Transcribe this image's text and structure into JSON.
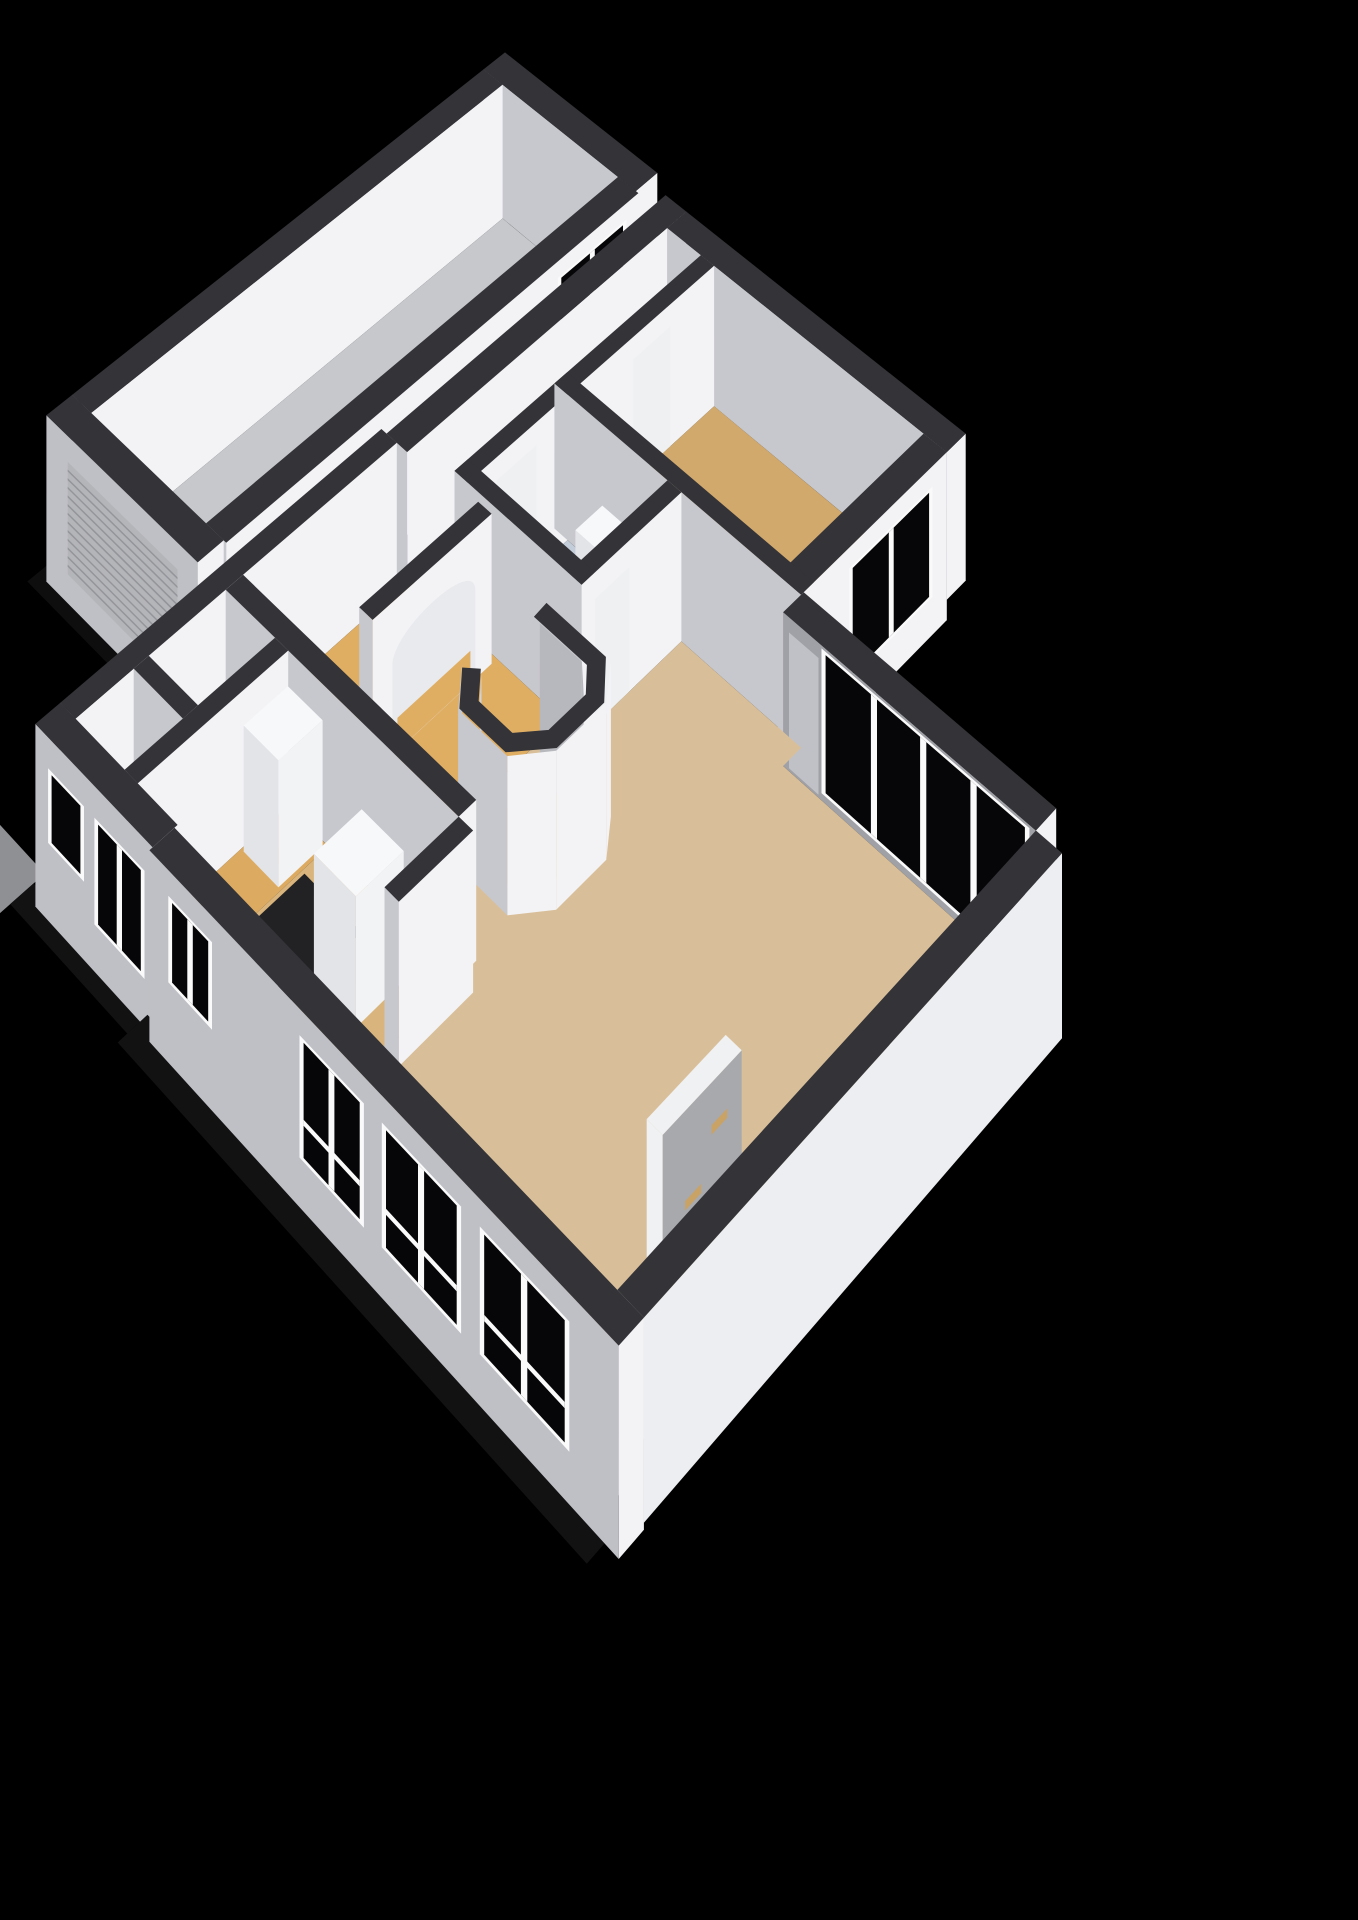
{
  "scene": {
    "proj": {
      "ox": 505,
      "oy": 185,
      "ux": 47.5,
      "uy": 39,
      "uz": 52,
      "p": 0.0107
    },
    "wallH": 2.55,
    "palette": {
      "bg": "#000000",
      "wallTop": "#333338",
      "wallBright": "#f3f3f6",
      "wallShade": "#c7c8cd",
      "wallShadeDark": "#a0a1a6",
      "extShade": "#bfc0c5",
      "glass": "#060608",
      "frame": "#fafafb",
      "floorGarage": "#c6c8cc",
      "floorCorridor": "#ced1d6",
      "floorBed": "#d2a96d",
      "floorBath": "#c3cdd9",
      "floorHall": "#dfae63",
      "floorHall2": "#dcab61",
      "floorLiving": "#d9bf99",
      "floorKitchen": "#d9b57d",
      "floorToilet": "#c6cfda",
      "floorStorage": "#d3d5d9",
      "floorDark": "#222225",
      "ground": "#8f9094",
      "groundDim": "#39393c",
      "shadow": "#121213",
      "doorPanel": "#eef0f2",
      "doorGray": "#c0c1c6",
      "slabGray": "#a8a9ad",
      "slabWhite": "#f0f1f3",
      "gold": "#c9a266",
      "innerBright": "#d2d3d7",
      "innerShade": "#b7b8bd",
      "furnTop": "#f7f8fa",
      "furnBright": "#f2f3f5",
      "furnShade": "#e3e4e8",
      "roller": "#b4b5b9",
      "rollerLine": "#94959a",
      "archFill": "#e9eaed"
    },
    "elements": [
      {
        "t": "prism",
        "name": "garage-north-wall",
        "r": [
          0,
          0,
          3.1,
          0.45
        ]
      },
      {
        "t": "prism",
        "name": "garage-west-wall",
        "r": [
          0,
          0.45,
          0.4,
          8.3
        ]
      },
      {
        "t": "floor",
        "name": "garage-floor",
        "r": [
          0.4,
          0.45,
          2.75,
          8.3
        ],
        "fill": "floorGarage"
      },
      {
        "t": "prism",
        "name": "garage-east-wall",
        "r": [
          2.75,
          0.45,
          3.15,
          8.3
        ]
      },
      {
        "t": "window",
        "name": "garage-window",
        "edge": [
          [
            3.15,
            0.7
          ],
          [
            3.15,
            2.1
          ]
        ],
        "z": [
          0.35,
          2.25
        ],
        "panes": 2
      },
      {
        "t": "floor",
        "name": "garage-south-shadow",
        "r": [
          0.05,
          8.78,
          3.05,
          9.12
        ],
        "fill": "#0e0e0f"
      },
      {
        "t": "prism",
        "name": "garage-south-wall",
        "r": [
          0,
          8.3,
          3.1,
          8.75
        ],
        "z0": -0.35,
        "dark": "extShade"
      },
      {
        "t": "panel",
        "name": "garage-roller-door",
        "edge": [
          [
            0.45,
            8.75
          ],
          [
            2.7,
            8.75
          ]
        ],
        "z": [
          0.15,
          2.1
        ],
        "fill": "roller",
        "stripes": 12,
        "stripeColor": "rollerLine"
      },
      {
        "t": "prism",
        "name": "house-northwest-wall",
        "r": [
          3.45,
          0.2,
          3.85,
          5.7
        ]
      },
      {
        "t": "prism",
        "name": "bedroom-north-wall",
        "r": [
          3.85,
          0.2,
          8.95,
          0.6
        ]
      },
      {
        "t": "floor",
        "name": "corridor-floor",
        "r": [
          3.85,
          0.6,
          4.5,
          5.45
        ],
        "fill": "floorCorridor"
      },
      {
        "t": "prism",
        "name": "corridor-east-wall",
        "r": [
          4.5,
          0.6,
          4.75,
          5.45
        ]
      },
      {
        "t": "panel",
        "name": "bedroom-door",
        "edge": [
          [
            4.75,
            1.5
          ],
          [
            4.75,
            2.25
          ]
        ],
        "z": [
          0,
          2.15
        ],
        "fill": "doorPanel"
      },
      {
        "t": "panel",
        "name": "bathroom-west-door",
        "edge": [
          [
            4.75,
            4.15
          ],
          [
            4.75,
            4.9
          ]
        ],
        "z": [
          0,
          2.15
        ],
        "fill": "doorPanel"
      },
      {
        "t": "floor",
        "name": "bedroom-floor",
        "r": [
          4.75,
          0.6,
          8.55,
          3.3
        ],
        "fill": "floorBed"
      },
      {
        "t": "prism",
        "name": "bedroom-east-wall",
        "r": [
          8.55,
          0.6,
          8.95,
          3.55
        ],
        "z0": -0.35
      },
      {
        "t": "window",
        "name": "bedroom-window",
        "edge": [
          [
            8.95,
            0.9
          ],
          [
            8.95,
            2.6
          ]
        ],
        "z": [
          0.3,
          2.2
        ],
        "panes": 2
      },
      {
        "t": "prism",
        "name": "bedroom-south-wall",
        "r": [
          4.5,
          3.3,
          8.95,
          3.55
        ]
      },
      {
        "t": "floor",
        "name": "bathroom-floor",
        "r": [
          4.75,
          3.55,
          6.6,
          5.2
        ],
        "fill": "floorBath"
      },
      {
        "t": "prism",
        "name": "bathroom-sink",
        "r": [
          5.45,
          3.6,
          6.15,
          4.12
        ],
        "z0": 0.78,
        "z1": 1.22,
        "top": "furnTop",
        "bright": "furnBright",
        "dark": "furnShade"
      },
      {
        "t": "prism",
        "name": "shower-screen",
        "r": [
          6.28,
          4.7,
          6.6,
          5.2
        ],
        "z1": 2.0,
        "top": "#d7d9dd",
        "bright": "#dcdee2",
        "dark": "#cdd0d5"
      },
      {
        "t": "prism",
        "name": "bathroom-east-wall",
        "r": [
          6.6,
          3.55,
          6.85,
          5.45
        ]
      },
      {
        "t": "panel",
        "name": "bathroom-door",
        "edge": [
          [
            6.85,
            4.55
          ],
          [
            6.85,
            5.3
          ]
        ],
        "z": [
          0,
          2.1
        ],
        "fill": "doorPanel"
      },
      {
        "t": "prism",
        "name": "bathroom-south-wall",
        "r": [
          4.5,
          5.2,
          6.85,
          5.45
        ]
      },
      {
        "t": "prism",
        "name": "utility-west-wall",
        "r": [
          3.35,
          5.7,
          3.65,
          11.25
        ]
      },
      {
        "t": "prism",
        "name": "living-north-wall",
        "r": [
          8.95,
          3.5,
          13.05,
          3.9
        ],
        "dark": "wallShadeDark"
      },
      {
        "t": "panel",
        "name": "terrace-door",
        "edge": [
          [
            9.05,
            3.9
          ],
          [
            9.55,
            3.9
          ]
        ],
        "z": [
          0.05,
          2.3
        ],
        "fill": "doorGray"
      },
      {
        "t": "window",
        "name": "living-window-band",
        "edge": [
          [
            9.6,
            3.9
          ],
          [
            12.95,
            3.9
          ]
        ],
        "z": [
          0.12,
          2.5
        ],
        "panes": 4
      },
      {
        "t": "floor",
        "name": "hall-floor",
        "r": [
          3.65,
          5.45,
          6.5,
          8.45
        ],
        "fill": "floorHall"
      },
      {
        "t": "floor",
        "name": "living-floor",
        "pts": [
          [
            6.85,
            3.55
          ],
          [
            8.95,
            3.55
          ],
          [
            8.95,
            3.9
          ],
          [
            13.05,
            3.9
          ],
          [
            13.05,
            11.3
          ],
          [
            7.95,
            11.3
          ],
          [
            7.95,
            8.75
          ],
          [
            6.5,
            8.75
          ],
          [
            6.5,
            5.45
          ],
          [
            6.85,
            5.45
          ]
        ],
        "fill": "floorLiving"
      },
      {
        "t": "prism",
        "name": "arch-wall",
        "r": [
          5.05,
          5.55,
          5.3,
          7.7
        ]
      },
      {
        "t": "arch",
        "name": "arched-opening",
        "edge": [
          [
            5.3,
            5.85
          ],
          [
            5.3,
            7.35
          ]
        ],
        "fill": "archFill",
        "floorFill": "floorHall"
      },
      {
        "t": "floor",
        "name": "stairwell-floor",
        "pts": [
          [
            6.85,
            6.22
          ],
          [
            7.6,
            6.22
          ],
          [
            7.92,
            6.52
          ],
          [
            7.92,
            7.15
          ],
          [
            7.6,
            7.5
          ],
          [
            7.05,
            7.5
          ],
          [
            6.8,
            7.22
          ]
        ],
        "fill": "floorHall"
      },
      {
        "t": "wallpath",
        "name": "stairwell-inner-wall",
        "pts": [
          [
            6.8,
            7.22
          ],
          [
            7.05,
            7.5
          ],
          [
            7.6,
            7.5
          ],
          [
            7.92,
            7.15
          ],
          [
            7.92,
            6.52
          ],
          [
            7.6,
            6.22
          ],
          [
            6.85,
            6.22
          ]
        ],
        "bright": "innerBright",
        "dark": "innerShade"
      },
      {
        "t": "wallpath",
        "name": "stairwell-outer-wall",
        "pts": [
          [
            6.6,
            5.95
          ],
          [
            7.85,
            5.95
          ],
          [
            8.2,
            6.4
          ],
          [
            8.2,
            7.3
          ],
          [
            7.82,
            7.78
          ],
          [
            6.95,
            7.78
          ],
          [
            6.55,
            7.32
          ]
        ]
      },
      {
        "t": "ringtop",
        "name": "stairwell-wall-top",
        "pts": [
          [
            6.72,
            6.08
          ],
          [
            7.72,
            6.08
          ],
          [
            8.06,
            6.46
          ],
          [
            8.06,
            7.22
          ],
          [
            7.71,
            7.64
          ],
          [
            7.0,
            7.64
          ],
          [
            6.67,
            7.27
          ]
        ],
        "w": 0.34
      },
      {
        "t": "prism",
        "name": "utility-north-wall",
        "r": [
          3.65,
          8.45,
          7.95,
          8.75
        ]
      },
      {
        "t": "floor",
        "name": "storage-floor",
        "r": [
          3.65,
          8.75,
          4.6,
          10.05
        ],
        "fill": "floorStorage"
      },
      {
        "t": "prism",
        "name": "toilet-divider-wall",
        "r": [
          3.65,
          10.05,
          4.6,
          10.3
        ]
      },
      {
        "t": "floor",
        "name": "toilet-floor",
        "r": [
          3.65,
          10.3,
          4.6,
          11.25
        ],
        "fill": "floorToilet"
      },
      {
        "t": "prism",
        "name": "utility-divider-wall",
        "r": [
          4.6,
          8.75,
          4.85,
          11.25
        ]
      },
      {
        "t": "floor",
        "name": "back-hall-floor",
        "r": [
          4.85,
          8.75,
          5.6,
          11.3
        ],
        "fill": "floorHall2"
      },
      {
        "t": "prism",
        "name": "closet-cabinet",
        "r": [
          4.9,
          8.8,
          5.55,
          9.55
        ],
        "z1": 2.05,
        "top": "furnTop",
        "bright": "furnBright",
        "dark": "furnShade"
      },
      {
        "t": "floor",
        "name": "kitchen-floor",
        "r": [
          5.6,
          8.75,
          7.95,
          11.3
        ],
        "fill": "floorKitchen"
      },
      {
        "t": "floor",
        "name": "kitchen-dark-floor",
        "r": [
          5.65,
          9.2,
          6.7,
          10.45
        ],
        "fill": "floorDark"
      },
      {
        "t": "prism",
        "name": "refrigerator",
        "r": [
          6.75,
          9.25,
          7.5,
          10.05
        ],
        "z1": 2.05,
        "top": "furnTop",
        "bright": "furnBright",
        "dark": "furnShade"
      },
      {
        "t": "prism",
        "name": "kitchen-counter",
        "r": [
          5.65,
          10.5,
          6.6,
          11.25
        ],
        "z1": 1.0,
        "top": "furnTop",
        "bright": "furnBright",
        "dark": "furnShade"
      },
      {
        "t": "prism",
        "name": "kitchen-living-wall",
        "r": [
          7.95,
          8.75,
          8.2,
          10.0
        ]
      },
      {
        "t": "prism",
        "name": "tv-wall",
        "r": [
          11.85,
          8.2,
          12.1,
          9.55
        ],
        "z1": 2.2,
        "top": "slabWhite",
        "bright": "slabGray",
        "dark": "slabWhite"
      },
      {
        "t": "panel",
        "name": "tv-bracket-upper",
        "edge": [
          [
            12.1,
            8.45
          ],
          [
            12.1,
            8.72
          ]
        ],
        "z": [
          1.42,
          1.56
        ],
        "fill": "gold"
      },
      {
        "t": "panel",
        "name": "tv-bracket-lower",
        "edge": [
          [
            12.1,
            8.9
          ],
          [
            12.1,
            9.17
          ]
        ],
        "z": [
          0.72,
          0.86
        ],
        "fill": "gold"
      },
      {
        "t": "prism",
        "name": "living-east-wall",
        "r": [
          13.05,
          3.9,
          13.45,
          11.3
        ],
        "z0": -0.35,
        "bright": "#eceef1"
      },
      {
        "t": "floor",
        "name": "driveway",
        "r": [
          2.45,
          11.5,
          3.35,
          13.0
        ],
        "fill": "ground"
      },
      {
        "t": "floor",
        "name": "driveway-shadow",
        "r": [
          2.45,
          12.6,
          3.35,
          13.35
        ],
        "fill": "groundDim"
      },
      {
        "t": "floor",
        "name": "utility-south-shadow",
        "r": [
          3.35,
          11.68,
          5.6,
          12.05
        ],
        "fill": "shadow"
      },
      {
        "t": "prism",
        "name": "utility-south-wall",
        "r": [
          3.35,
          11.25,
          5.6,
          11.65
        ],
        "z0": -0.4,
        "dark": "extShade"
      },
      {
        "t": "window",
        "name": "utility-window-left",
        "edge": [
          [
            3.6,
            11.65
          ],
          [
            4.3,
            11.65
          ]
        ],
        "z": [
          0.85,
          2.05
        ],
        "panes": 1
      },
      {
        "t": "window",
        "name": "utility-window-right",
        "edge": [
          [
            4.5,
            11.65
          ],
          [
            5.45,
            11.65
          ]
        ],
        "z": [
          0.35,
          2.05
        ],
        "panes": 2
      },
      {
        "t": "floor",
        "name": "living-south-shadow",
        "r": [
          5.6,
          11.73,
          13.45,
          12.2
        ],
        "fill": "shadow"
      },
      {
        "t": "prism",
        "name": "living-south-wall",
        "r": [
          5.6,
          11.3,
          13.45,
          11.7
        ],
        "z0": -0.45,
        "dark": "extShade"
      },
      {
        "t": "window",
        "name": "kitchen-window",
        "edge": [
          [
            5.95,
            11.7
          ],
          [
            6.75,
            11.7
          ]
        ],
        "z": [
          0.8,
          2.15
        ],
        "panes": 2
      },
      {
        "t": "window",
        "name": "living-window-south-1",
        "edge": [
          [
            8.3,
            11.7
          ],
          [
            9.4,
            11.7
          ]
        ],
        "z": [
          0.3,
          2.15
        ],
        "panes": 2,
        "rail": 0.32
      },
      {
        "t": "window",
        "name": "living-window-south-2",
        "edge": [
          [
            9.7,
            11.7
          ],
          [
            11.0,
            11.7
          ]
        ],
        "z": [
          0.3,
          2.15
        ],
        "panes": 2,
        "rail": 0.32
      },
      {
        "t": "window",
        "name": "living-window-south-3",
        "edge": [
          [
            11.3,
            11.7
          ],
          [
            12.7,
            11.7
          ]
        ],
        "z": [
          0.3,
          2.15
        ],
        "panes": 2,
        "rail": 0.32
      }
    ]
  }
}
